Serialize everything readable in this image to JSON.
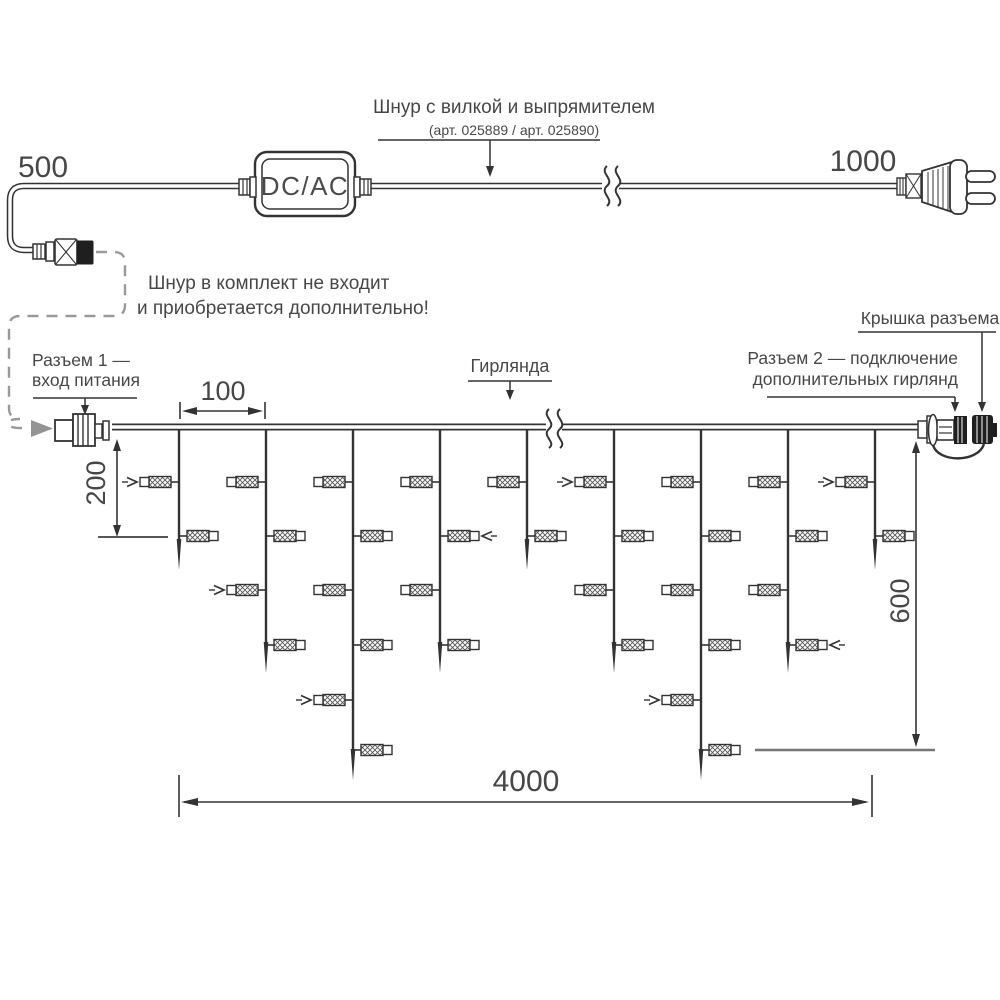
{
  "labels": {
    "cord_length_left": "500",
    "cord_length_right": "1000",
    "converter": "DC/AC",
    "cord_title": "Шнур с вилкой и выпрямителем",
    "cord_articles": "(арт. 025889 / арт. 025890)",
    "note_line1": "Шнур в комплект не входит",
    "note_line2": "и приобретается дополнительно!",
    "connector1_line1": "Разъем 1 —",
    "connector1_line2": "вход питания",
    "garland": "Гирлянда",
    "cap": "Крышка разъема",
    "connector2_line1": "Разъем 2 — подключение",
    "connector2_line2": "дополнительных гирлянд",
    "dim_spacing": "100",
    "dim_short_drop": "200",
    "dim_long_drop": "600",
    "dim_total_length": "4000"
  },
  "colors": {
    "ink": "#333333",
    "text": "#474747",
    "muted_gray": "#949494",
    "cap_black": "#1f1f1f"
  },
  "garland": {
    "wire_y": 427,
    "drop_xs": [
      179,
      266,
      353,
      440,
      527,
      614,
      701,
      788,
      875
    ],
    "pattern": [
      "short",
      "medium",
      "long",
      "medium",
      "short",
      "medium",
      "long",
      "medium",
      "short"
    ],
    "tip_y": {
      "short": 570,
      "medium": 673,
      "long": 780
    },
    "lamp_rows_y": [
      482,
      536,
      590,
      645,
      700,
      750
    ],
    "lamps_per_type": {
      "short": 2,
      "medium": 4,
      "long": 6
    },
    "arrow_right_marks": [
      [
        0,
        0
      ],
      [
        1,
        2
      ],
      [
        2,
        4
      ],
      [
        5,
        0
      ],
      [
        6,
        4
      ],
      [
        8,
        0
      ]
    ],
    "arrow_left_marks": [
      [
        3,
        1
      ],
      [
        7,
        3
      ]
    ]
  }
}
